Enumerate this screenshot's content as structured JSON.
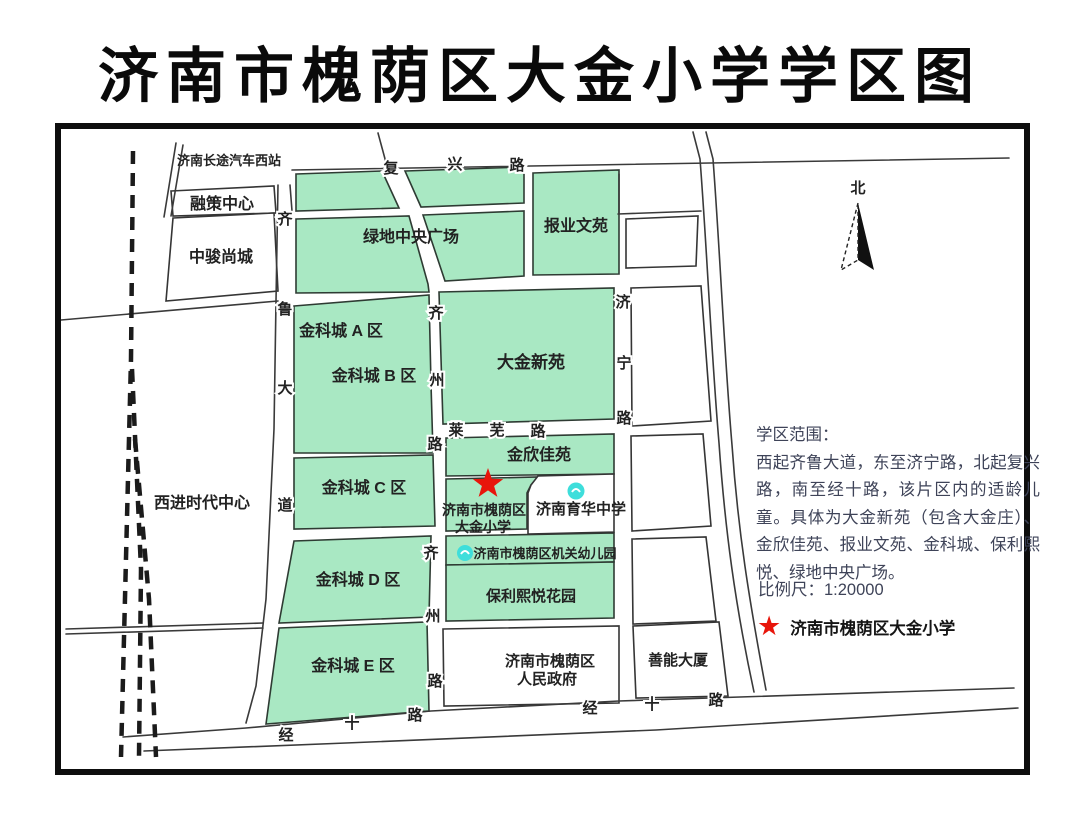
{
  "title": "济南市槐荫区大金小学学区图",
  "colors": {
    "district_green": "#A9E8C3",
    "star_red": "#E8150B",
    "marker_cyan": "#3EDEDB"
  },
  "map": {
    "north_label": "北",
    "places": {
      "bus_station": "济南长途汽车西站",
      "rongce_center": "融策中心",
      "zhongjun_shangcheng": "中骏尚城",
      "xijin_times_center": "西进时代中心",
      "greenland_plaza": "绿地中央广场",
      "baoye_wenyuan": "报业文苑",
      "jinke_a": "金科城 A 区",
      "jinke_b": "金科城 B 区",
      "jinke_c": "金科城 C 区",
      "jinke_d": "金科城 D 区",
      "jinke_e": "金科城 E 区",
      "dajin_xinyuan": "大金新苑",
      "jinxin_jiayuan": "金欣佳苑",
      "school_line1": "济南市槐荫区",
      "school_line2": "大金小学",
      "yuhua_school": "济南育华中学",
      "kindergarten": "济南市槐荫区机关幼儿园",
      "baoli_xiyue": "保利熙悦花园",
      "government_line1": "济南市槐荫区",
      "government_line2": "人民政府",
      "shanneng_building": "善能大厦"
    },
    "roads": {
      "fuxing": {
        "name": "复兴路"
      },
      "qilu": {
        "name": "齐鲁大道"
      },
      "qizhou": {
        "name": "齐州路"
      },
      "jining": {
        "name": "济宁路"
      },
      "laiwu": {
        "name": "莱芜路"
      },
      "jingshi": {
        "name": "经十路"
      }
    },
    "description": {
      "heading": "学区范围：",
      "body": "西起齐鲁大道，东至济宁路，北起复兴路，南至经十路，该片区内的适龄儿童。具体为大金新苑（包含大金庄）、金欣佳苑、报业文苑、金科城、保利熙悦、绿地中央广场。"
    },
    "scale_label": "比例尺：1:20000",
    "legend": {
      "star_label": "济南市槐荫区大金小学"
    }
  }
}
